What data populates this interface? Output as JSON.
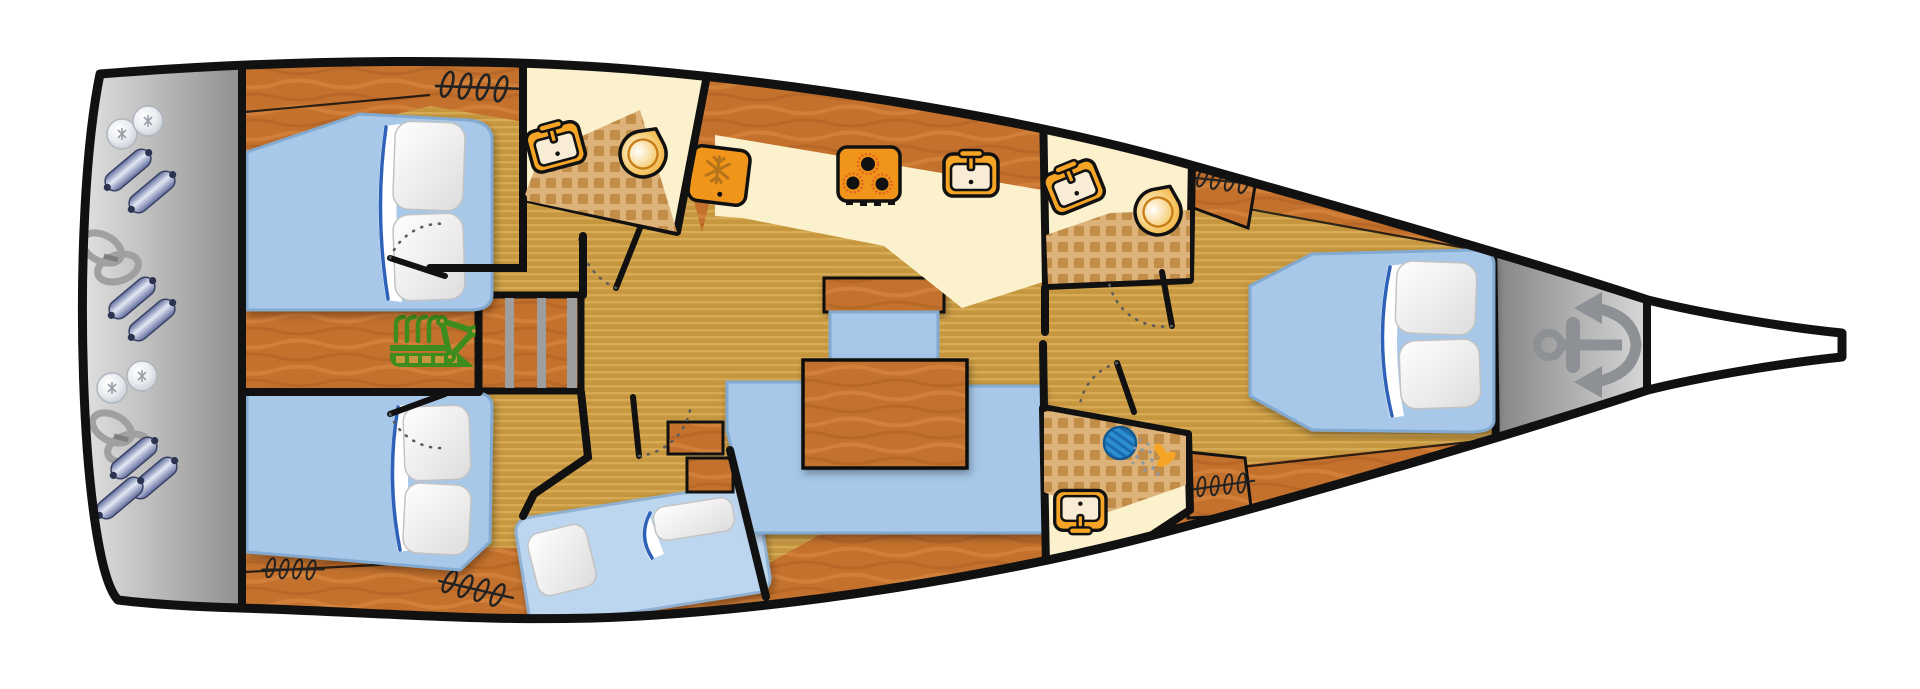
{
  "diagram": {
    "type": "sailboat-interior-deck-plan",
    "orientation": {
      "bow": "right",
      "stern": "left"
    },
    "palette": {
      "outline": "#111111",
      "hull_fill": "#ffffff",
      "floor_base": "#c6973f",
      "floor_stripe": "#d7ab55",
      "wood": "#c3712d",
      "wood_light": "#d5853e",
      "wood_dark": "#a85c20",
      "cream": "#fbf1cd",
      "tile_bg": "#dcb279",
      "tile_sq": "#c28c49",
      "bed_blue": "#a7c8e9",
      "bed_blue_light": "#bdd6ef",
      "bed_edge": "#82a9cf",
      "fold_blue": "#2f62b8",
      "gray_light": "#ececec",
      "gray_dark": "#8f8f8f",
      "locker_dark": "#848484",
      "locker_light": "#d8d8d8",
      "anchor_gray": "#8d9094",
      "orange": "#f5a426",
      "orange_deep": "#f0951a",
      "burner_glow": "#e2641f",
      "icon_cream": "#f8ecd7",
      "snowflake": "#b5731b",
      "engine_green": "#3e8c1d",
      "drain_blue": "#2f8ed0",
      "drain_blue_dark": "#1b6db0",
      "spray_gray": "#8f98a5",
      "fender_dark": "#5f6c9e",
      "fender_light": "#e4e9f4",
      "rope_gray": "#a0a0a0"
    },
    "areas": [
      {
        "name": "stern-deck-storage",
        "equipment": [
          "fender",
          "fender",
          "fender",
          "fender",
          "fender",
          "fender",
          "fender",
          "buoy-ball",
          "buoy-ball",
          "buoy-ball",
          "buoy-ball",
          "mooring-rope-coil",
          "mooring-rope-coil"
        ]
      },
      {
        "name": "aft-cabin-top",
        "furniture": [
          "double-bed",
          "pillow",
          "pillow",
          "wardrobe-hangers"
        ]
      },
      {
        "name": "aft-cabin-bottom",
        "furniture": [
          "double-bed",
          "pillow",
          "pillow",
          "wardrobe-hangers",
          "wardrobe-hangers"
        ]
      },
      {
        "name": "engine-compartment",
        "equipment": [
          "engine"
        ]
      },
      {
        "name": "companionway-stairs",
        "steps": 3
      },
      {
        "name": "aft-head",
        "fixtures": [
          "washbasin",
          "toilet"
        ],
        "floor": "tile-and-cream"
      },
      {
        "name": "galley",
        "appliances": [
          "refrigerator",
          "stove-3-burners",
          "washbasin"
        ]
      },
      {
        "name": "salon",
        "furniture": [
          "u-shaped-sofa",
          "wood-table",
          "bench-seat"
        ]
      },
      {
        "name": "mid-cabin",
        "furniture": [
          "double-bed",
          "pillow",
          "pillow"
        ]
      },
      {
        "name": "forward-head",
        "fixtures": [
          "washbasin",
          "toilet"
        ],
        "floor": "tile-and-cream"
      },
      {
        "name": "shower-room",
        "fixtures": [
          "shower-drain",
          "shower-head",
          "washbasin"
        ],
        "floor": "tile-and-cream"
      },
      {
        "name": "forward-cabin",
        "furniture": [
          "double-bed",
          "pillow",
          "pillow",
          "wardrobe-hangers",
          "wardrobe-hangers"
        ]
      },
      {
        "name": "anchor-locker",
        "equipment": [
          "anchor"
        ]
      },
      {
        "name": "bowsprit"
      }
    ],
    "icons": {
      "anchor": "gray anchor glyph pointing to bow",
      "engine": "green engine block with pipes and belt triangle",
      "washbasin": "orange square, cream basin, faucet, drain dot",
      "toilet": "orange circle with pointed corner, radial highlight",
      "refrigerator": "orange rounded square with snowflake",
      "stove": "orange square with 3 black burners",
      "shower-drain": "blue hatched circle",
      "shower-head": "orange sprayer with gray spray dots",
      "wardrobe-hangers": "coiled hanger squiggle on rail",
      "fender": "blue-gray capsule",
      "buoy-ball": "glossy gray sphere",
      "mooring-rope-coil": "gray figure-eight coil"
    }
  }
}
